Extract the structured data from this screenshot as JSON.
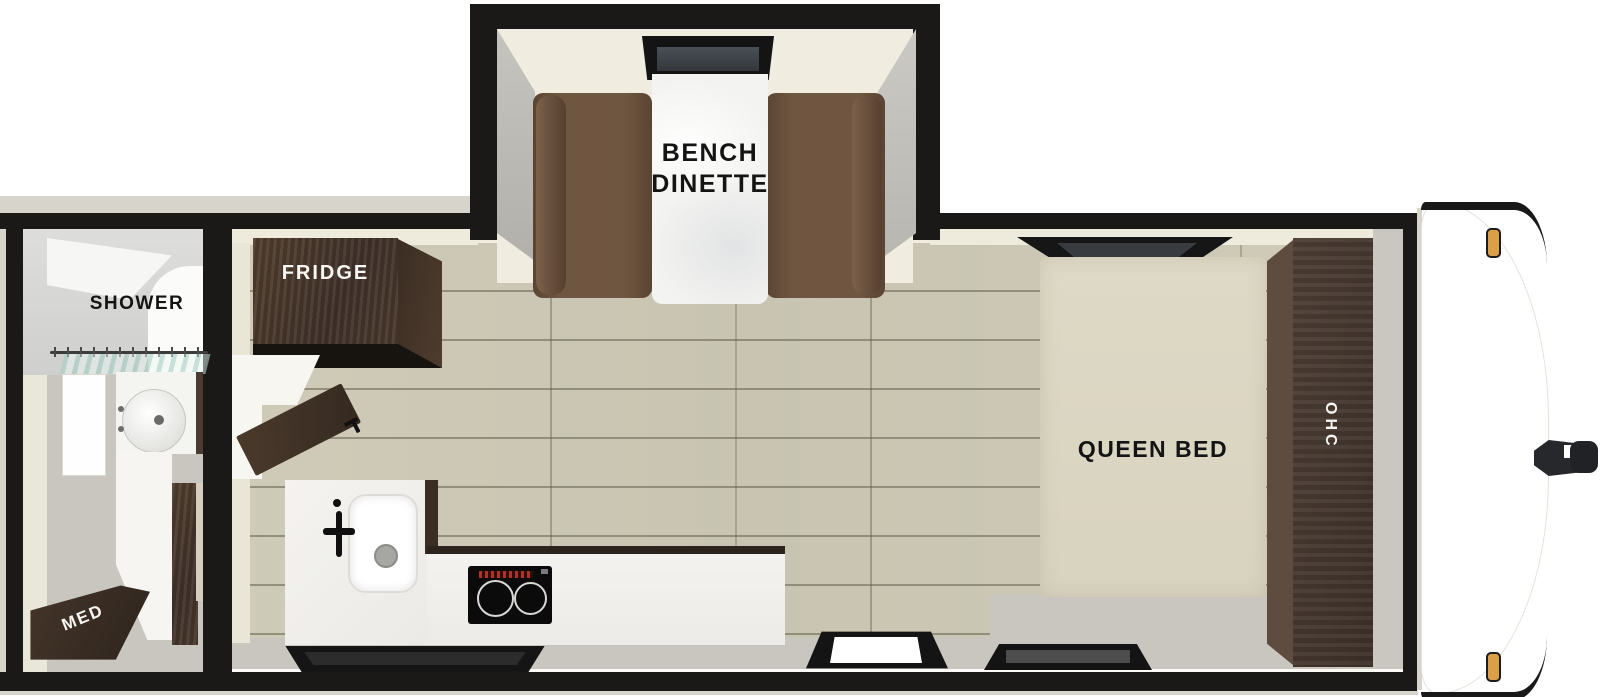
{
  "floorplan": {
    "type": "travel-trailer-floorplan",
    "labels": {
      "dinette_line1": "BENCH",
      "dinette_line2": "DINETTE",
      "fridge": "FRIDGE",
      "shower": "SHOWER",
      "med": "MED",
      "queen_bed": "QUEEN BED",
      "ohc": "OHC"
    },
    "colors": {
      "wall_black": "#1b1917",
      "interior_cream": "#f0ede0",
      "floor_wood": "#ccc8b5",
      "floor_gray": "#c8c6bf",
      "cabinet_dark_brown": "#46372b",
      "bench_brown": "#6f5641",
      "bed_cream": "#dcd7c3",
      "counter_white": "#f1f0ed",
      "clearance_light_amber": "#dd9f45",
      "window_glass_dark": "#3f444a"
    }
  }
}
